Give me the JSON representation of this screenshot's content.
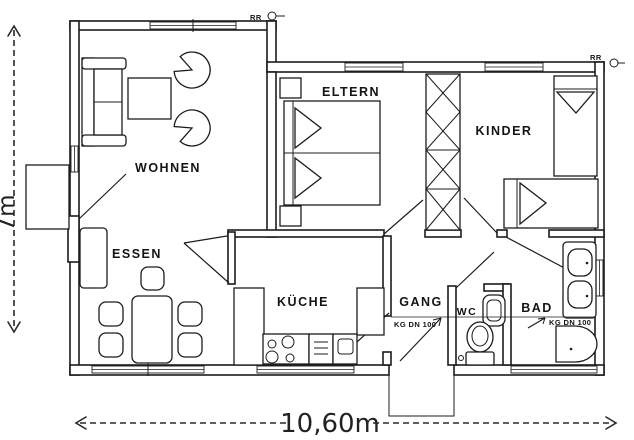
{
  "plan": {
    "rooms": {
      "wohnen": "WOHNEN",
      "essen": "ESSEN",
      "eltern": "ELTERN",
      "kinder": "KINDER",
      "kueche": "KÜCHE",
      "gang": "GANG",
      "wc": "WC",
      "bad": "BAD"
    },
    "annotations": {
      "rr_left": "RR",
      "rr_right": "RR",
      "kg_gang": "KG DN 100",
      "kg_bad": "KG DN 100"
    },
    "dimensions": {
      "height": "7m",
      "width": "10,60m"
    },
    "colors": {
      "line": "#1c1c1c",
      "paper": "#ffffff"
    }
  }
}
